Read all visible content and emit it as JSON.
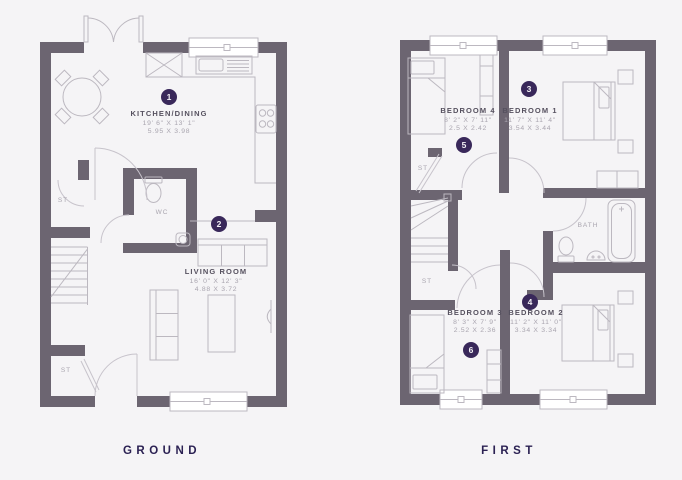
{
  "colors": {
    "background": "#f5f4f6",
    "wall": "#6c6571",
    "fixture_line": "#bcb8c0",
    "accent_circle": "#39285a",
    "room_name_text": "#56515f",
    "dimension_text": "#a9a5af",
    "floor_label_text": "#2b2153"
  },
  "ground": {
    "floor_label": "GROUND",
    "kitchen": {
      "number": "1",
      "name": "KITCHEN/DINING",
      "imperial": "19' 6\" X 13' 1\"",
      "metric": "5.95 X 3.98"
    },
    "living": {
      "number": "2",
      "name": "LIVING ROOM",
      "imperial": "16' 0\" X 12' 3\"",
      "metric": "4.88 X 3.72"
    },
    "wc_label": "WC",
    "storage_hall_label": "ST",
    "storage_entry_label": "ST",
    "fixtures": [
      "french-doors",
      "window",
      "dining-table",
      "chairs",
      "kitchen-counter",
      "sink",
      "hob",
      "appliance",
      "toilet",
      "corner-basin",
      "stairs",
      "sofa",
      "coffee-table",
      "tv"
    ]
  },
  "first": {
    "floor_label": "FIRST",
    "bedroom1": {
      "number": "3",
      "name": "BEDROOM 1",
      "imperial": "11' 7\" X 11' 4\"",
      "metric": "3.54 X 3.44"
    },
    "bedroom2": {
      "number": "4",
      "name": "BEDROOM 2",
      "imperial": "11' 2\" X 11' 0\"",
      "metric": "3.34 X 3.34"
    },
    "bedroom4": {
      "number": "5",
      "name": "BEDROOM 4",
      "imperial": "8' 2\" X 7' 11\"",
      "metric": "2.5 X 2.42"
    },
    "bedroom3": {
      "number": "6",
      "name": "BEDROOM 3",
      "imperial": "8' 3\" X 7' 9\"",
      "metric": "2.52 X 2.36"
    },
    "bath_label": "BATH",
    "storage_landing_label": "ST",
    "storage_stairs_label": "ST",
    "fixtures": [
      "window",
      "single-bed",
      "double-bed",
      "wardrobe",
      "bedside-table",
      "stairs",
      "bathtub",
      "toilet",
      "basin"
    ]
  }
}
